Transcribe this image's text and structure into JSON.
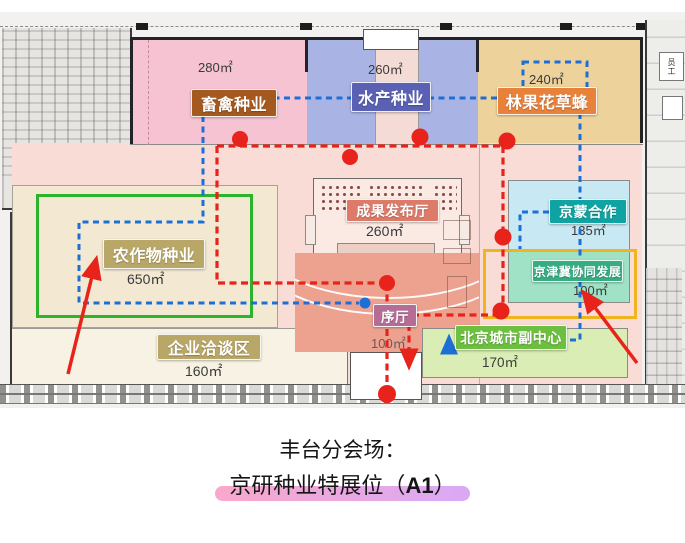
{
  "colors": {
    "red_route": "#e8231b",
    "blue_route": "#1d6fd6",
    "highlight_from": "#f9a8c9",
    "highlight_to": "#d9a9f7",
    "yellow_frame": "#f0b41f",
    "green_booth": "#2cb42c"
  },
  "zones": {
    "livestock": {
      "label": "畜禽种业",
      "area": "280㎡",
      "color": "#f5c3d2",
      "label_bg": "#a4591f"
    },
    "aquatic": {
      "label": "水产种业",
      "area": "260㎡",
      "color": "#a9b3e4",
      "label_bg": "#5a61b5"
    },
    "forest_fruit": {
      "label": "林果花草蜂",
      "area": "240㎡",
      "color": "#eed29c",
      "label_bg": "#e8813a"
    },
    "crops": {
      "label": "农作物种业",
      "area": "650㎡",
      "color": "#f3e8d2",
      "label_bg": "#b9a768"
    },
    "negotiation": {
      "label": "企业洽谈区",
      "area": "160㎡",
      "color": "#f7f2e3",
      "label_bg": "#b9a768"
    },
    "release_hall": {
      "label": "成果发布厅",
      "area": "260㎡",
      "color": "#fbeae4",
      "label_bg": "#dd7a68"
    },
    "preface_hall": {
      "label": "序厅",
      "area": "100㎡",
      "color": "#eca28e",
      "label_bg": "#b56d96"
    },
    "jingmeng": {
      "label": "京蒙合作",
      "area": "135㎡",
      "color": "#c8e9f3",
      "label_bg": "#10a3a3"
    },
    "jingjinji": {
      "label": "京津冀协同发展",
      "area": "100㎡",
      "color": "#9fe2c6",
      "label_bg": "#36ae83"
    },
    "subcenter": {
      "label": "北京城市副中心",
      "area": "170㎡",
      "color": "#d9edb4",
      "label_bg": "#6cbf3f"
    }
  },
  "corridor": {
    "staff_label": "员工"
  },
  "caption": {
    "line1": "丰台分会场：",
    "line2_pre": "京研种业特展位（",
    "line2_em": "A1",
    "line2_post": "）"
  }
}
